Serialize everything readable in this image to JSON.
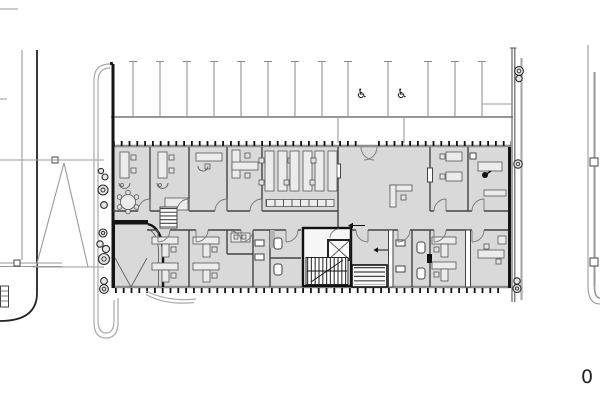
{
  "title": "Architectural floor plan — office building with parking row",
  "scale_label": "0",
  "icons": {
    "accessible_parking_icon": "♿",
    "bollard_icon": "double circle",
    "stair_icon": "hatched treads",
    "elevator_icon": "crossed box"
  },
  "counts": {
    "parking_stripes": 13,
    "accessible_parking_spaces": 2,
    "bollards_left": 10,
    "bollards_right": 5,
    "stairs": 3,
    "elevators": 1
  },
  "colors": {
    "background": "#ffffff",
    "building_fill": "#d9d9d9",
    "exterior_wall": "#141414",
    "partition": "#444444",
    "site_line": "#9a9a9a",
    "parking_line": "#8a8a8a",
    "furniture_fill": "#ececec",
    "symbol": "#111111"
  }
}
